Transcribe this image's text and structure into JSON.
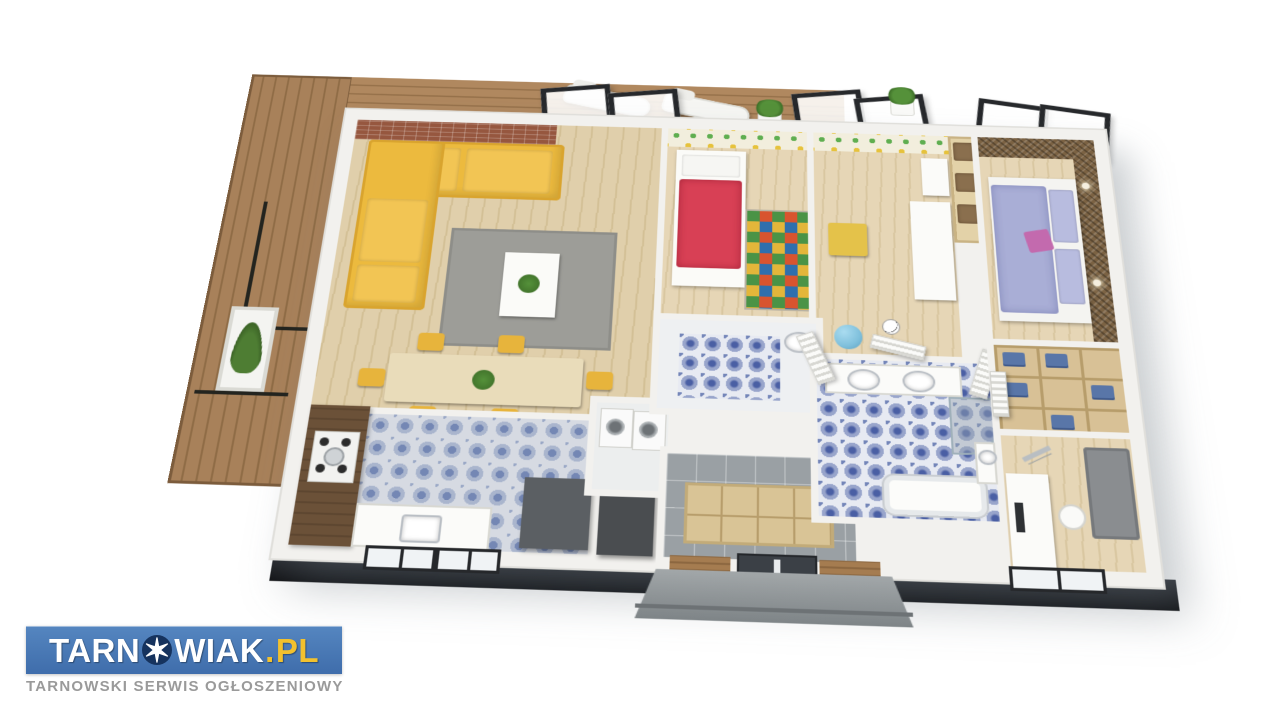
{
  "watermark": {
    "part1": "TARN",
    "star_glyph": "✶",
    "part2": "WIAK",
    "dot": ".",
    "tld": "PL",
    "subtitle": "TARNOWSKI SERWIS OGŁOSZENIOWY",
    "colors": {
      "banner": "#4a7bb5",
      "text": "#ffffff",
      "tld": "#f2c12e",
      "star_circle": "#16335e",
      "subtitle": "#9a9a9a"
    }
  },
  "scene": {
    "type": "3d-isometric-floor-plan-render",
    "background": "#ffffff",
    "rooms": [
      {
        "name": "terrace deck",
        "floor": "wood decking",
        "items": [
          "two white sun loungers",
          "black metal railing",
          "grass planter",
          "potted plants",
          "black framed sliding glass doors"
        ]
      },
      {
        "name": "living room",
        "floor": "light wood",
        "items": [
          "yellow corner sofa",
          "brick accent wall",
          "gray area rug",
          "white coffee table with plant"
        ]
      },
      {
        "name": "dining area",
        "floor": "light wood",
        "items": [
          "light wood dining table",
          "six yellow chairs",
          "green plant centerpiece",
          "place settings"
        ]
      },
      {
        "name": "kitchen",
        "floor": "blue patterned tile",
        "items": [
          "dark wood counter",
          "gas hob with pot",
          "sink under black framed windows",
          "gray island",
          "amber glass vases",
          "dark sideboard"
        ]
      },
      {
        "name": "laundry",
        "floor": "gray",
        "items": [
          "washing machine",
          "dryer",
          "white cabinet"
        ]
      },
      {
        "name": "entry hall",
        "floor": "gray tile",
        "items": [
          "anthracite front door with glass strip",
          "concrete porch steps",
          "wood slat wall panels",
          "open cubby shelving"
        ]
      },
      {
        "name": "kids bedroom",
        "floor": "light wood",
        "items": [
          "red single bed",
          "colorful patchwork play rug",
          "kids pattern wallpaper"
        ]
      },
      {
        "name": "playroom",
        "floor": "light wood",
        "items": [
          "white desk",
          "yellow side table",
          "soccer ball",
          "blue gym ball",
          "wall shelf",
          "kids pattern wallpaper"
        ]
      },
      {
        "name": "kids bathroom",
        "floor": "blue patterned tile",
        "items": [
          "white tiled walls",
          "wash basin",
          "standing wood framed mirror"
        ]
      },
      {
        "name": "master bedroom",
        "floor": "light wood",
        "items": [
          "double bed with lavender bedding",
          "pink accent pillow",
          "rattan feature wall",
          "wall sconces",
          "wicker basket shelving"
        ]
      },
      {
        "name": "walk-in closet",
        "floor": "light wood",
        "items": [
          "open wood shelving",
          "folded blue clothes",
          "white louvered doors"
        ]
      },
      {
        "name": "main bathroom",
        "floor": "blue ornate tile",
        "items": [
          "double vanity with two basins",
          "corner glass shower",
          "bathtub",
          "white louvered doors"
        ]
      },
      {
        "name": "study",
        "floor": "light wood",
        "items": [
          "white desk with monitor",
          "white chair",
          "telescope on tripod",
          "gray sofa",
          "black framed window",
          "small basin cabinet"
        ]
      }
    ],
    "palette": {
      "wall": "#f2f1ee",
      "plinth": "#17181b",
      "deck_wood": "#a8815a",
      "floor_wood": "#ddcba4",
      "brick": "#96573f",
      "sofa_yellow": "#ecba3e",
      "rug_gray": "#9d9d98",
      "kitchen_tile": "#7487b4",
      "bath_tile": "#4a5fa4",
      "entry_tile": "#9aa0a4",
      "bed_red": "#d84055",
      "bed_lavender": "#a9aed6",
      "accent_pink": "#c36aae",
      "clothes_blue": "#5976a8",
      "gym_ball": "#7fc0dc",
      "sofa_gray": "#8a8d90",
      "door_dark": "#3b4046",
      "frame_black": "#26282b",
      "porch_concrete": "#969a9c",
      "rattan": "#7b6243",
      "plant_green": "#4e8f3a"
    }
  }
}
